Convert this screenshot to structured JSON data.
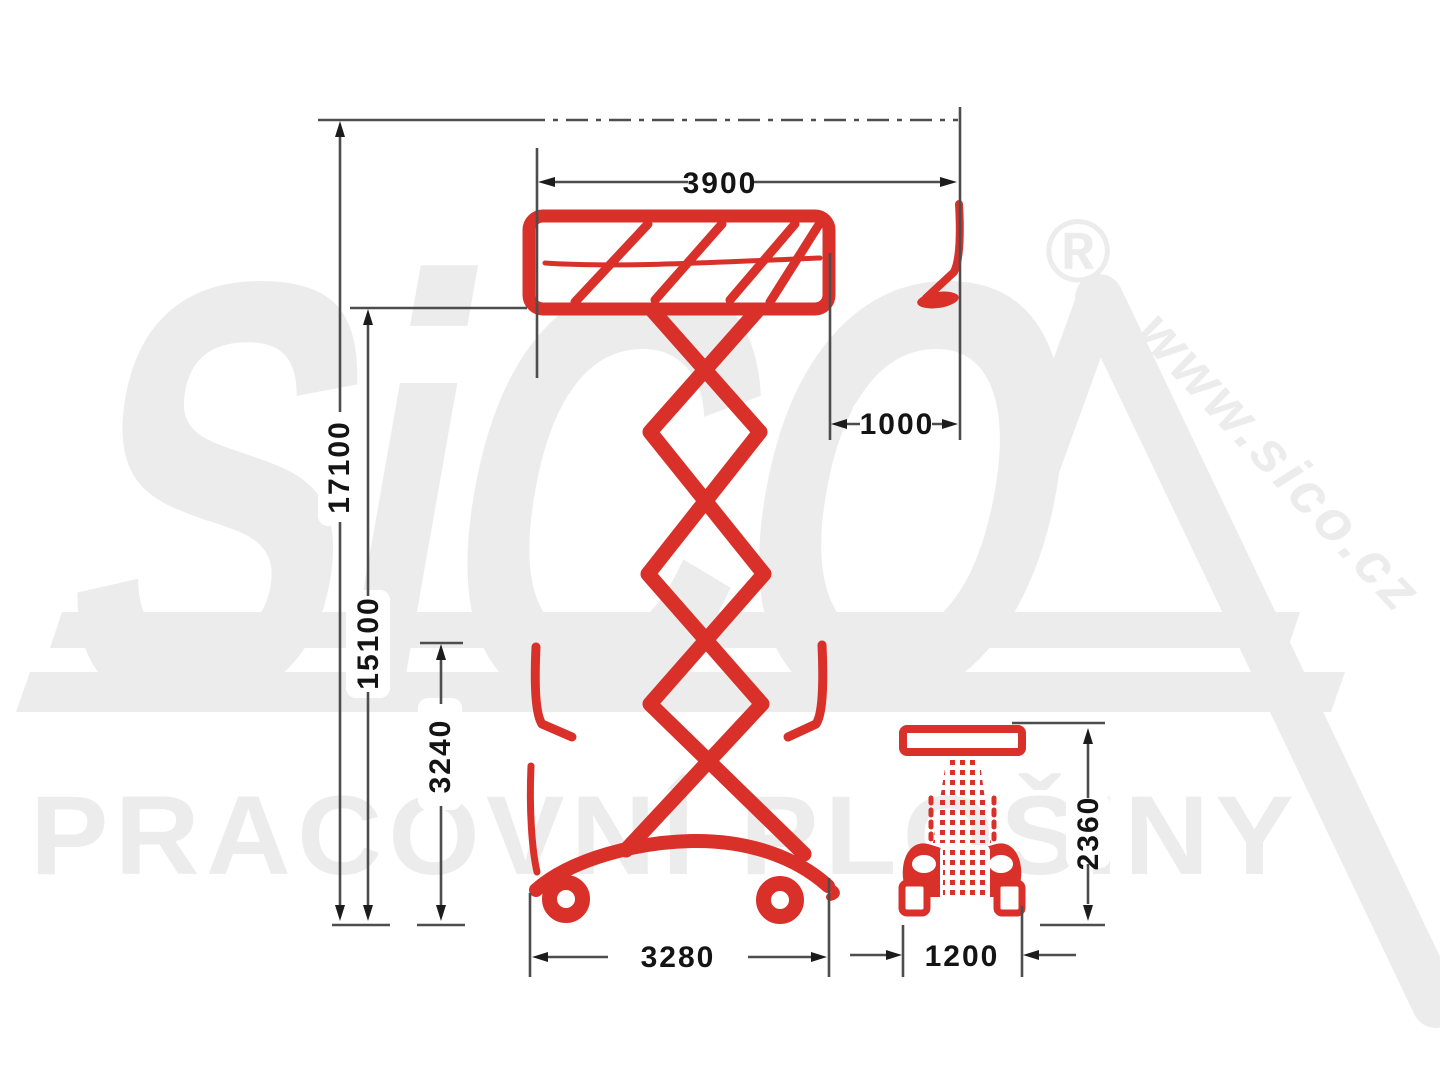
{
  "dimensions": {
    "platform_length": "3900",
    "platform_extension": "1000",
    "max_working_height": "17100",
    "max_platform_height": "15100",
    "stowed_height": "3240",
    "overall_length": "3280",
    "overall_width": "1200",
    "stowed_rear_height": "2360"
  },
  "watermarks": {
    "brand": "SiCO",
    "registered_mark": "®",
    "website": "www.sico.cz",
    "tagline": "PRACOVNÍ PLOŠINY"
  },
  "colors": {
    "machine_red": "#d9302a",
    "dimension_line": "#4d4d4d",
    "dimension_text": "#141414",
    "watermark_gray": "#ececec"
  }
}
